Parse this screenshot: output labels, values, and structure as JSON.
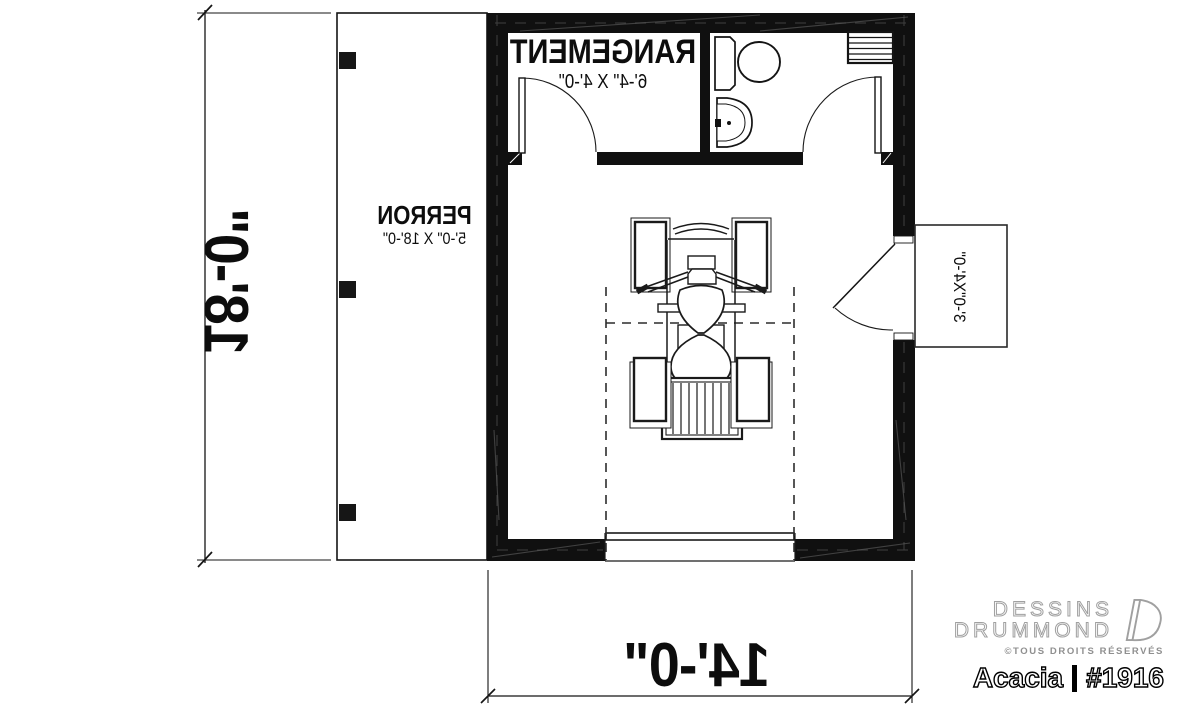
{
  "plan": {
    "rooms": [
      {
        "name": "RANGEMENT",
        "dims": "6'-4\" X 4'-0\""
      },
      {
        "name": "PERRON",
        "dims": "5'-0\" X 18'-0\""
      }
    ],
    "dim_width": "14'-0\"",
    "dim_height": "18'-0\"",
    "stoop_dims": "3'-0\"X4'-0\"",
    "colors": {
      "ink": "#111111",
      "background": "#ffffff"
    }
  },
  "branding": {
    "name_line1": "DESSINS",
    "name_line2": "DRUMMOND",
    "rights": "©TOUS DROITS RÉSERVÉS",
    "plan_name": "Acacia",
    "plan_number": "#1916",
    "logo_gray": "#9e9e9e"
  }
}
